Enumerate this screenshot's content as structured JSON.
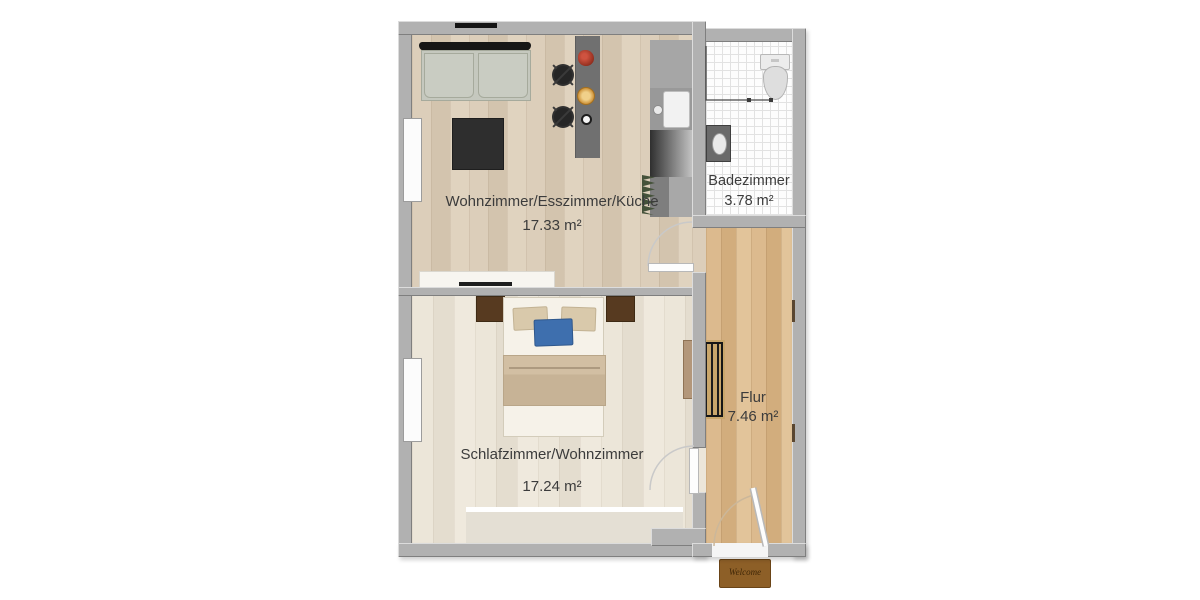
{
  "rooms": [
    {
      "id": "living",
      "label": "Wohnzimmer/Esszimmer/Küche",
      "area": "17.33 m²"
    },
    {
      "id": "bathroom",
      "label": "Badezimmer",
      "area": "3.78 m²"
    },
    {
      "id": "hall",
      "label": "Flur",
      "area": "7.46 m²"
    },
    {
      "id": "bedroom",
      "label": "Schlafzimmer/Wohnzimmer",
      "area": "17.24 m²"
    }
  ],
  "doormat": {
    "text": "Welcome"
  },
  "fixtures": [
    "sofa-icon",
    "coffee-table-icon",
    "dining-table-icon",
    "chair-icon",
    "flower-pot-icon",
    "bowl-icon",
    "cup-icon",
    "kitchen-counter-icon",
    "kitchen-sink-icon",
    "stove-icon",
    "plant-icon",
    "tv-lowboard-icon",
    "bed-icon",
    "pillow-icon",
    "nightstand-icon",
    "wardrobe-shelf-icon",
    "rug-icon",
    "radiator-icon",
    "toilet-icon",
    "washbasin-icon",
    "shower-rail-icon",
    "window-icon",
    "door-swing-icon",
    "doormat-icon"
  ],
  "colors": {
    "wall": "#b1b1b1",
    "floor_living": "#dcceba",
    "floor_bedroom": "#ece6d9",
    "floor_hall": "#dcba8e",
    "floor_bath": "#fdfdfd",
    "label_text": "#3c3c3c",
    "bed_blanket": "#cdb99c",
    "pillow_blue": "#3e6fae",
    "wood_dark": "#573a20",
    "doormat": "#8d5f27",
    "sofa": "#c5c8be",
    "counter_gray": "#a0a0a0"
  }
}
